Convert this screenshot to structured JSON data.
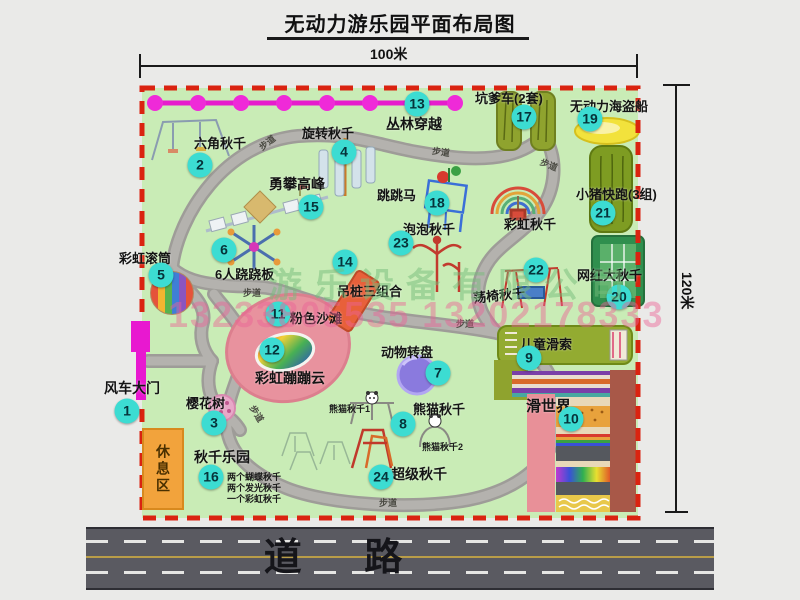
{
  "title": "无动力游乐园平面布局图",
  "dimensions": {
    "top": "100米",
    "right": "120米"
  },
  "road": {
    "label": "道  路"
  },
  "trail_label": "步道",
  "rest_area_label": "休息区",
  "watermark": {
    "company": "游乐设备有限公司",
    "phone": "13233805535 13202178333"
  },
  "colors": {
    "map_green": "#c9ecb6",
    "border_red": "#da2310",
    "badge_cyan": "#3cdcd2",
    "path_gray": "#a8a6a2",
    "road_gray": "#5a5a61",
    "gate_magenta": "#e61ccd",
    "rest_orange": "#f2a33c",
    "beach_pink": "#e8929e",
    "turntable_purple": "#8a7ade",
    "boat_yellow": "#f2e23c"
  },
  "attractions": [
    {
      "num": "1",
      "label": "风车大门",
      "icon": "windmill-gate-icon"
    },
    {
      "num": "2",
      "label": "六角秋千",
      "icon": "hexagon-swing-icon"
    },
    {
      "num": "3",
      "label": "樱花树",
      "icon": "cherry-tree-icon"
    },
    {
      "num": "4",
      "label": "旋转秋千",
      "icon": "rotating-swing-icon"
    },
    {
      "num": "5",
      "label": "彩虹滚筒",
      "icon": "rainbow-roller-icon"
    },
    {
      "num": "6",
      "label": "6人跷跷板",
      "icon": "six-seat-seesaw-icon"
    },
    {
      "num": "7",
      "label": "动物转盘",
      "icon": "animal-turntable-icon"
    },
    {
      "num": "8",
      "label": "熊猫秋千",
      "icon": "panda-swing-icon",
      "subs": [
        "熊猫秋千1",
        "熊猫秋千2"
      ]
    },
    {
      "num": "9",
      "label": "儿童滑索",
      "icon": "kids-zipline-icon"
    },
    {
      "num": "10",
      "label": "滑世界",
      "icon": "slide-world-icon"
    },
    {
      "num": "11",
      "label": "粉色沙滩",
      "icon": "pink-beach-icon"
    },
    {
      "num": "12",
      "label": "彩虹蹦蹦云",
      "icon": "rainbow-bounce-cloud-icon"
    },
    {
      "num": "13",
      "label": "丛林穿越",
      "icon": "jungle-crossing-icon"
    },
    {
      "num": "14",
      "label": "吊桩三组合",
      "icon": "hanging-post-combo-icon"
    },
    {
      "num": "15",
      "label": "勇攀高峰",
      "icon": "climbing-peak-icon"
    },
    {
      "num": "16",
      "label": "秋千乐园",
      "icon": "swing-park-icon",
      "notes": [
        "两个蝴蝶秋千",
        "两个发光秋千",
        "一个彩虹秋千"
      ]
    },
    {
      "num": "17",
      "label": "坑爹车(2套)",
      "icon": "kart-track-icon"
    },
    {
      "num": "18",
      "label": "跳跳马",
      "icon": "jumping-horse-icon"
    },
    {
      "num": "19",
      "label": "无动力海盗船",
      "icon": "pirate-ship-icon"
    },
    {
      "num": "20",
      "label": "网红大秋千",
      "icon": "big-swing-icon"
    },
    {
      "num": "21",
      "label": "小猪快跑(3组)",
      "icon": "piggy-run-icon"
    },
    {
      "num": "22",
      "label": "荡椅秋千",
      "icon": "swing-chair-icon"
    },
    {
      "num": "23",
      "label": "泡泡秋千",
      "icon": "bubble-swing-icon"
    },
    {
      "num": "24",
      "label": "超级秋千",
      "icon": "super-swing-icon"
    },
    {
      "label": "彩虹秋千",
      "icon": "rainbow-arch-swing-icon"
    }
  ]
}
